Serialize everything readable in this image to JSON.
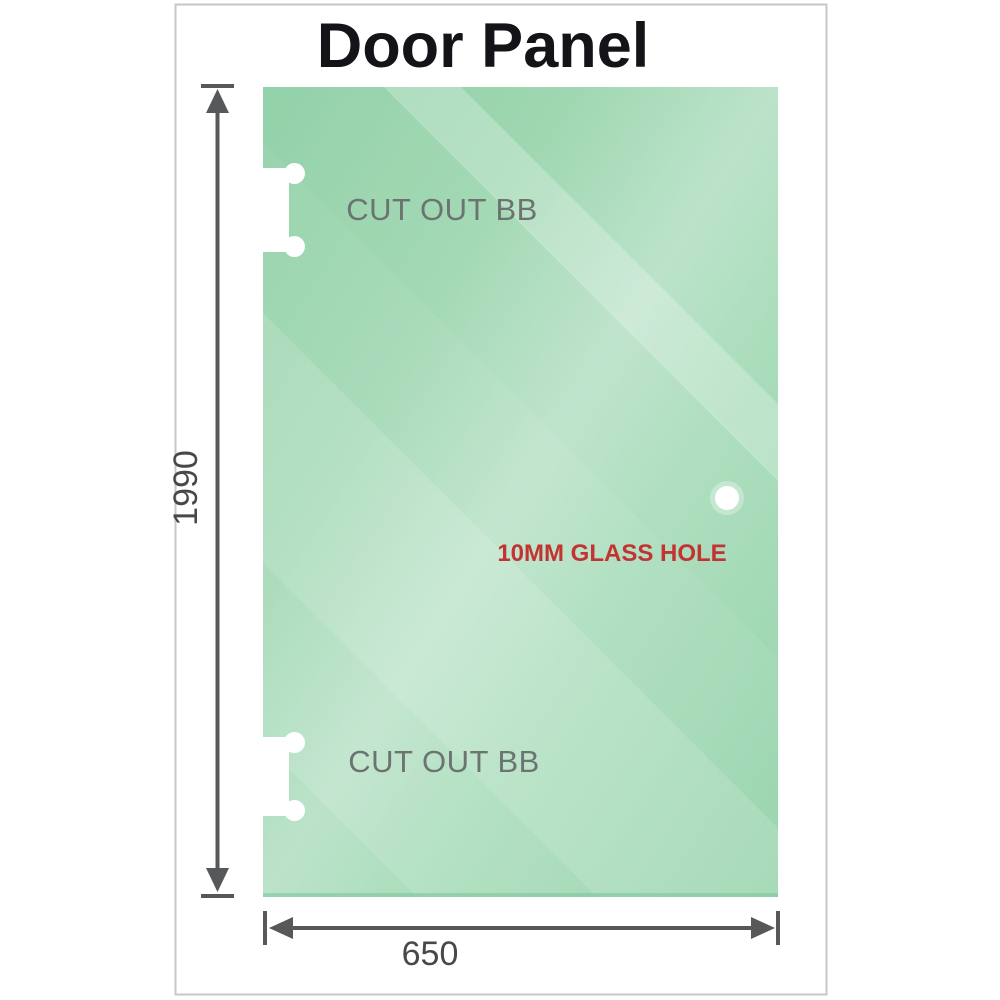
{
  "diagram": {
    "title": "Door Panel",
    "subject": "glass shower door panel drawing",
    "labels": {
      "cutout_top": "CUT OUT BB",
      "cutout_bottom": "CUT OUT BB",
      "glass_hole": "10MM GLASS HOLE"
    },
    "dimensions": {
      "height": "1990",
      "width": "650"
    },
    "colors": {
      "glass_green": "#8ccfa4",
      "glass_highlight": "#bce3ca",
      "dimension_line": "#57585a",
      "label_gray": "#6b7470",
      "hole_label_red": "#c23331",
      "frame_border": "#c7c7c7",
      "title_color": "#141418"
    },
    "icons": {
      "vertical_dimension_arrow": "double-headed vertical arrow with end ticks",
      "horizontal_dimension_arrow": "double-headed horizontal arrow with end ticks",
      "glass_hole_icon": "small white circle",
      "hinge_cutout_icon": "white bone-shaped edge notch"
    }
  }
}
